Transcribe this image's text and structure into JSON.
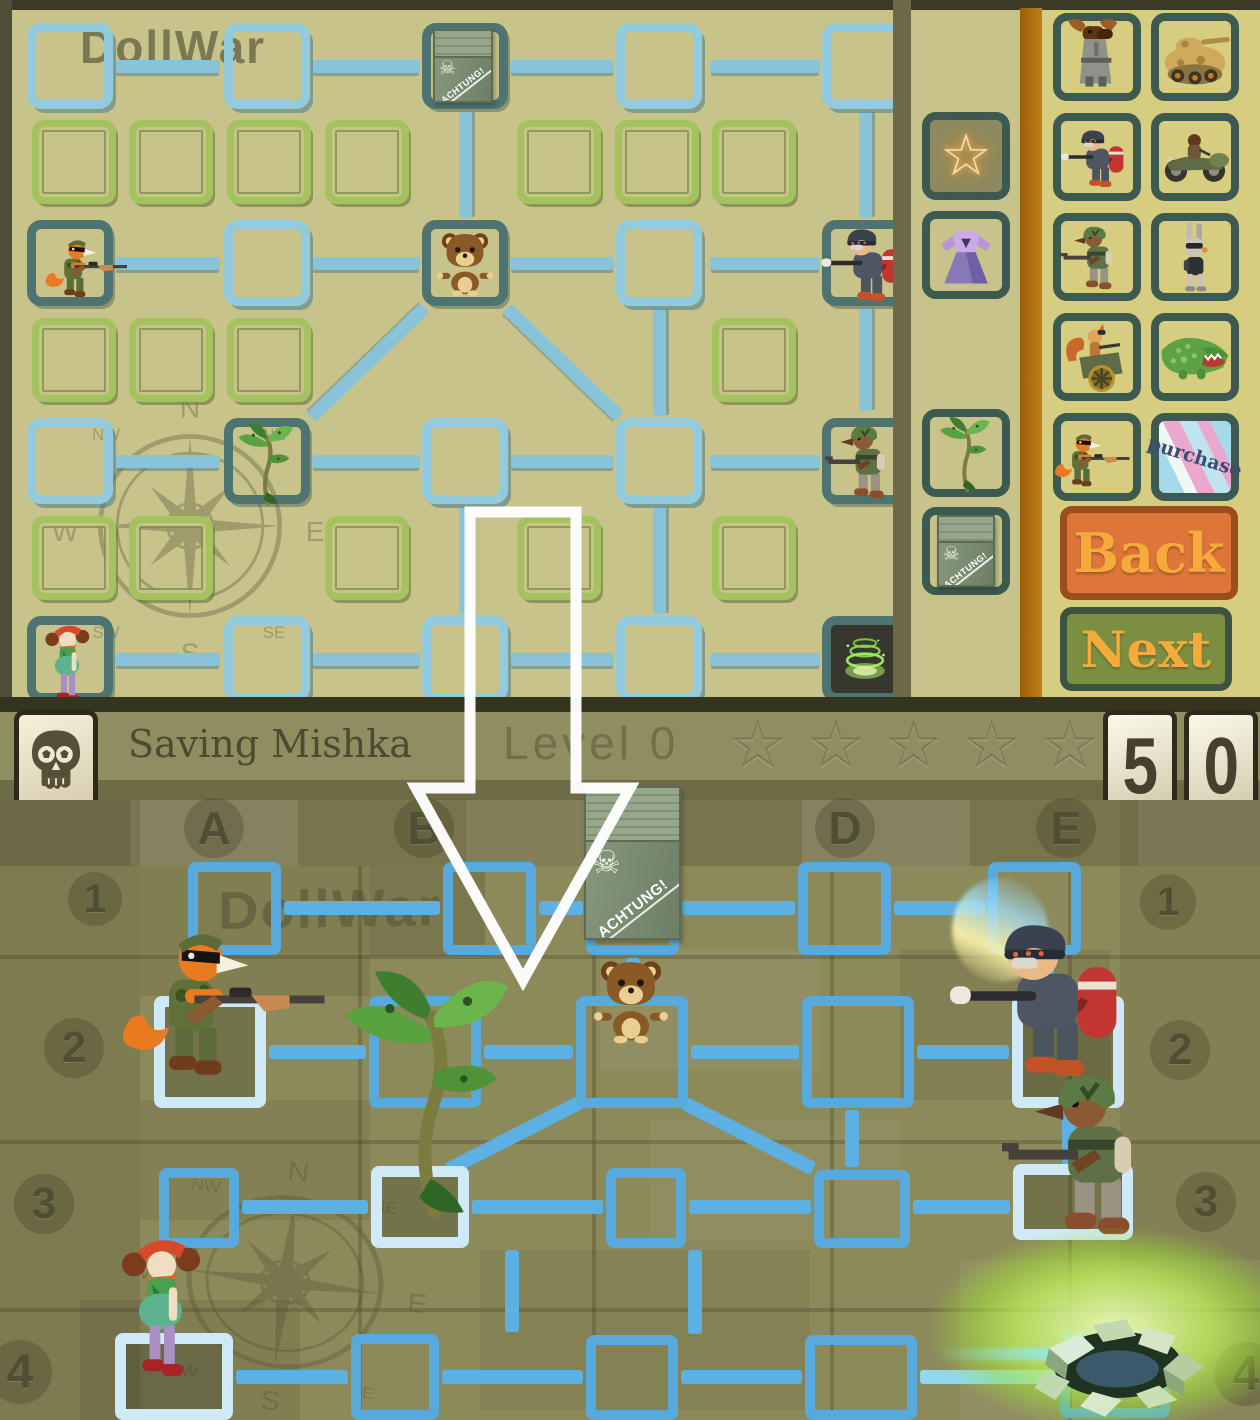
{
  "app": {
    "name": "DollWar"
  },
  "editor": {
    "watermark": "DollWar",
    "tools": [
      {
        "icon": "star-icon",
        "glyph": "☆"
      },
      {
        "icon": "dress-icon"
      },
      {
        "icon": "plant-icon"
      },
      {
        "icon": "crate-icon"
      }
    ],
    "units": [
      {
        "icon": "moose-soldier-icon"
      },
      {
        "icon": "tank-icon"
      },
      {
        "icon": "pig-flamethrower-icon"
      },
      {
        "icon": "motorcycle-sidecar-icon"
      },
      {
        "icon": "dog-soldier-icon"
      },
      {
        "icon": "rabbit-trooper-icon"
      },
      {
        "icon": "squirrel-gun-cart-icon"
      },
      {
        "icon": "crocodile-icon"
      },
      {
        "icon": "fox-rifleman-icon"
      },
      {
        "icon": "purchase-tile",
        "label": "purchase"
      }
    ],
    "back_label": "Back",
    "next_label": "Next"
  },
  "crate": {
    "label": "ACHTUNG!",
    "skull_glyph": "☠"
  },
  "hud": {
    "mission_title": "Saving Mishka",
    "level_label": "Level 0",
    "stars": [
      "☆",
      "☆",
      "☆",
      "☆",
      "☆"
    ],
    "score_digits": [
      "5",
      "0"
    ]
  },
  "board": {
    "watermark": "DollWar",
    "column_labels": [
      "A",
      "B",
      "D",
      "E"
    ],
    "row_labels_left": [
      "1",
      "2",
      "3",
      "4"
    ],
    "row_labels_right": [
      "1",
      "2",
      "3",
      "4"
    ],
    "compass": {
      "n": "N",
      "ne": "NE",
      "e": "E",
      "se": "SE",
      "s": "S",
      "sw": "SW",
      "w": "W",
      "nw": "NW"
    }
  },
  "colors": {
    "path_blue": "#57aadb",
    "node_blue": "#92cade",
    "cell_green": "#a4c25e",
    "editor_khaki": "#c7c38b",
    "panel_khaki": "#d6cd80",
    "accent_orange_stripe": "#b5740f",
    "back_button": "#dd7638",
    "next_button": "#7c8f41",
    "button_text": "#f4ab3c",
    "header_olive": "#8f8e61",
    "field_olive": "#8c895a",
    "highlight_blue": "#cfe9f6",
    "portal_green": "#9ae22c",
    "score_ink": "#46402e"
  }
}
